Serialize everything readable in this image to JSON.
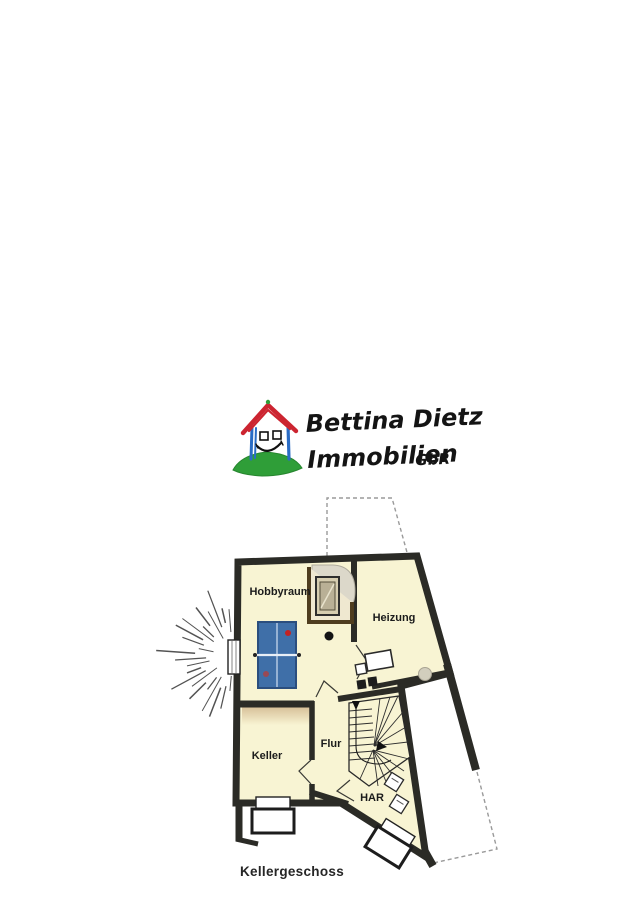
{
  "logo": {
    "line1": "Bettina Dietz",
    "line2": "Immobilien",
    "suffix": "GbR"
  },
  "floorplan": {
    "rooms": {
      "hobbyraum": "Hobbyraum",
      "heizung": "Heizung",
      "keller": "Keller",
      "flur": "Flur",
      "har": "HAR"
    },
    "caption": "Kellergeschoss",
    "colors": {
      "wall": "#2b2b26",
      "room_fill": "#f8f4d3",
      "table_blue": "#3f6fa8",
      "dash_gray": "#9a9a9a",
      "logo_red": "#cc2430",
      "logo_blue": "#2a6cc5",
      "logo_green": "#2f9e38"
    }
  }
}
